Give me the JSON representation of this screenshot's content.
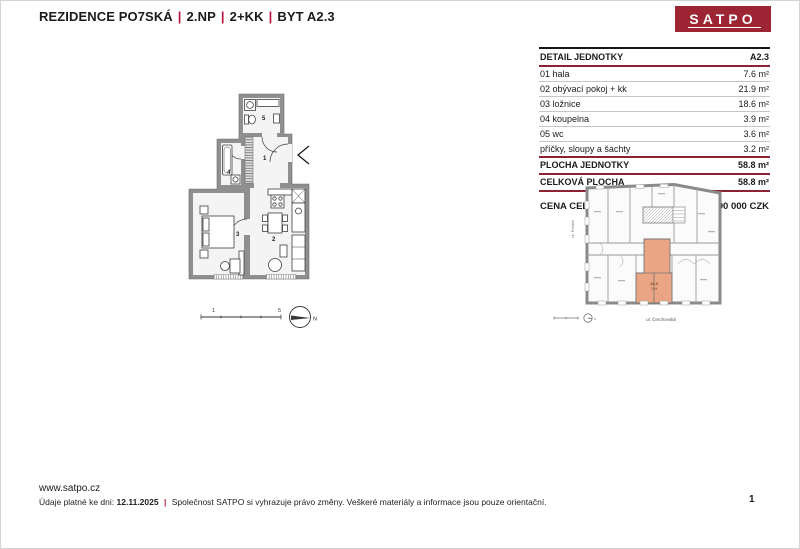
{
  "header": {
    "title_parts": [
      "REZIDENCE PO7SKÁ",
      "2.NP",
      "2+KK",
      "BYT A2.3"
    ],
    "separator": "|",
    "logo_text": "SATPO"
  },
  "unit_table": {
    "header_label": "DETAIL JEDNOTKY",
    "header_value": "A2.3",
    "rows": [
      {
        "label": "01 hala",
        "value": "7.6 m²"
      },
      {
        "label": "02 obývací pokoj + kk",
        "value": "21.9 m²"
      },
      {
        "label": "03 ložnice",
        "value": "18.6 m²"
      },
      {
        "label": "04 koupelna",
        "value": "3.9 m²"
      },
      {
        "label": "05 wc",
        "value": "3.6 m²"
      },
      {
        "label": "příčky, sloupy a šachty",
        "value": "3.2 m²"
      }
    ],
    "totals": [
      {
        "label": "PLOCHA JEDNOTKY",
        "value": "58.8 m²"
      },
      {
        "label": "CELKOVÁ PLOCHA",
        "value": "58.8 m²"
      }
    ],
    "price_label": "CENA CELKEM",
    "price_value": "15 590 000 CZK"
  },
  "floor_plan": {
    "labels": {
      "r1": "1",
      "r2": "2",
      "r3": "3",
      "r4": "4",
      "r5": "5"
    },
    "scale_start": "1",
    "scale_end": "5",
    "compass": "N"
  },
  "site_plan": {
    "unit_code": "A2.3",
    "unit_type": "2+kk",
    "street_left": "ul. Polská",
    "street_bottom": "ul. Čerchovská",
    "compass": "N"
  },
  "footer": {
    "website": "www.satpo.cz",
    "note_prefix": "Údaje platné ke dni:",
    "date": "12.11.2025",
    "separator": "|",
    "note": "Společnost SATPO si vyhrazuje právo změny. Veškeré materiály a informace jsou pouze orientační.",
    "page": "1"
  },
  "colors": {
    "brand_red": "#9c2433",
    "accent_red": "#b5123d",
    "table_line_red": "#8c2332",
    "unit_highlight": "#e9a584",
    "wall_gray": "#8f8f8f"
  }
}
